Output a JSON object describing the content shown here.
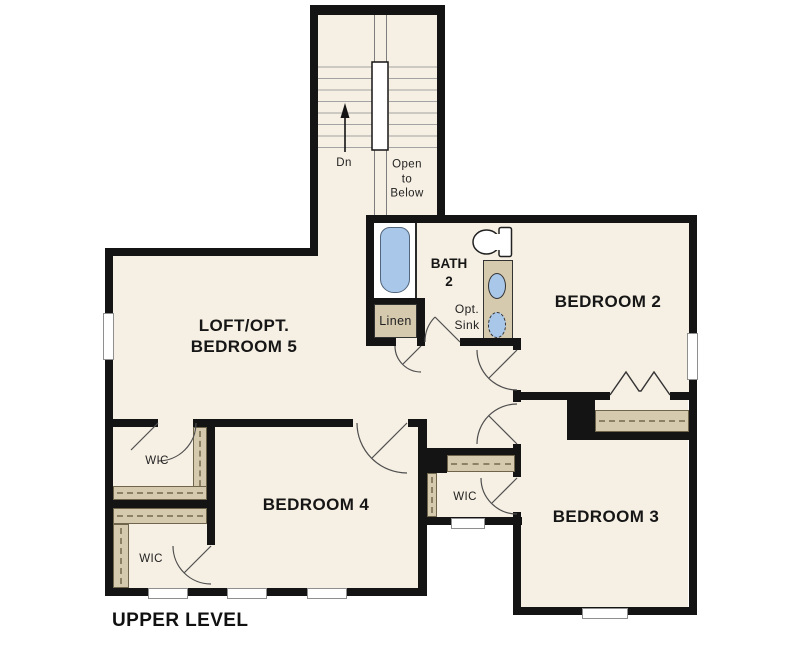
{
  "title": "UPPER LEVEL",
  "labels": {
    "loft_line1": "LOFT/OPT.",
    "loft_line2": "BEDROOM 5",
    "bedroom2": "BEDROOM 2",
    "bedroom3": "BEDROOM 3",
    "bedroom4": "BEDROOM 4",
    "bath_line1": "BATH",
    "bath_line2": "2",
    "opt_sink_line1": "Opt.",
    "opt_sink_line2": "Sink",
    "linen": "Linen",
    "wic": "WIC",
    "stairs_down": "Dn",
    "open_below_line1": "Open",
    "open_below_line2": "to",
    "open_below_line3": "Below"
  },
  "colors": {
    "background": "#ffffff",
    "floor": "#f6efe3",
    "wall": "#141414",
    "closet_rod": "#d5c9ae",
    "fixture_blue": "#a9c7e9",
    "label_text": "#161616"
  }
}
